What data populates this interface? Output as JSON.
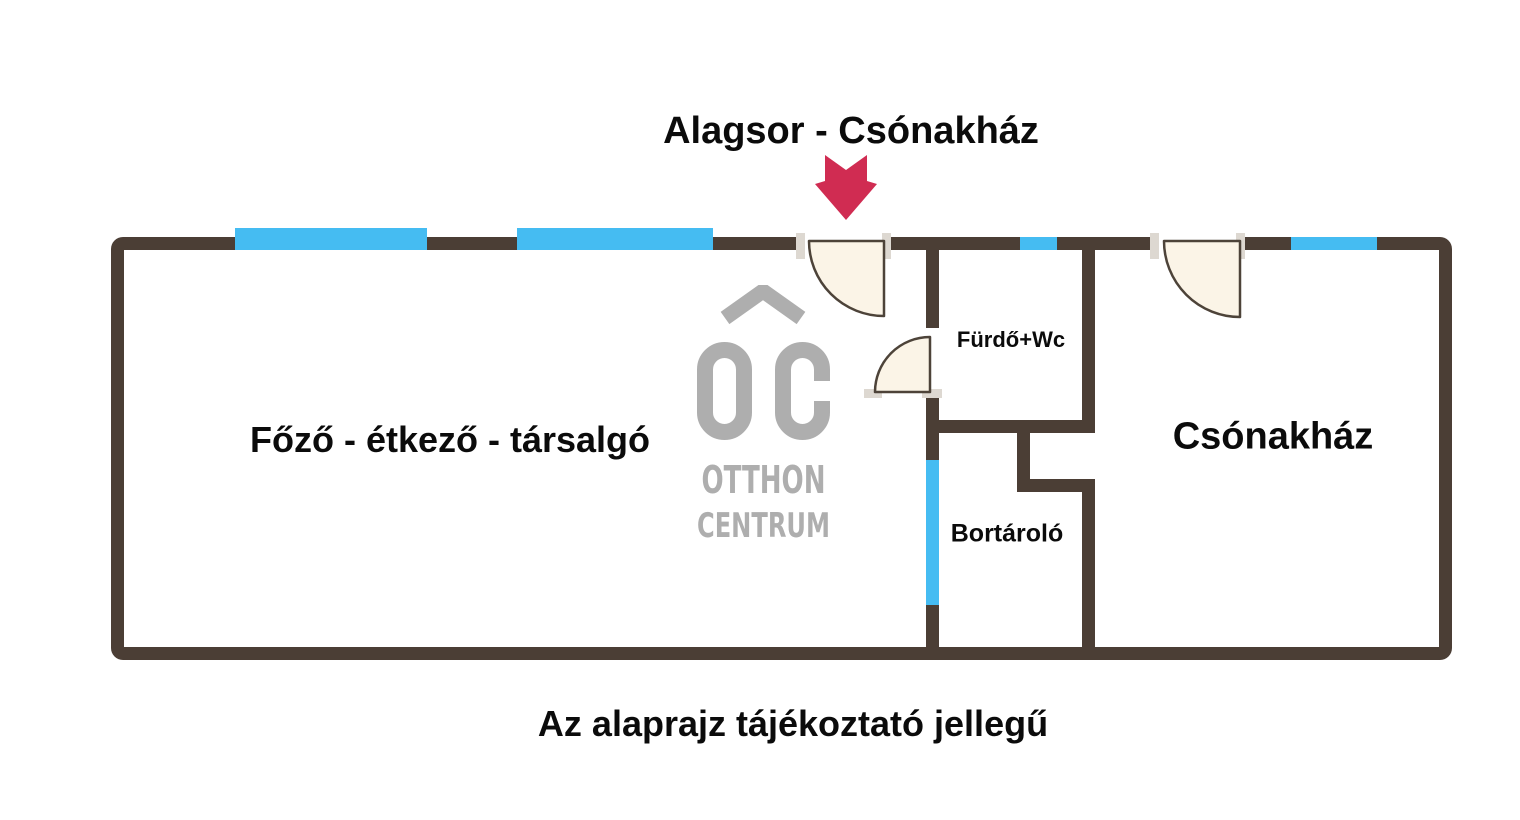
{
  "title": "Alagsor - Csónakház",
  "caption": "Az alaprajz tájékoztató jellegű",
  "logo": {
    "line1": "OTTHON",
    "line2": "CENTRUM"
  },
  "colors": {
    "wall": "#4B3E35",
    "window": "#45BCF2",
    "door_fill": "#FBF4E7",
    "door_stroke": "#4D4339",
    "hinge": "#DDD8D1",
    "arrow": "#D02C52",
    "logo": "#AEAEAE",
    "text": "#0B0B0B"
  },
  "rooms": [
    {
      "id": "fozo-etkezo-tarsalgo",
      "label": "Főző - étkező - társalgó",
      "cx": 450,
      "cy": 440,
      "font_size": 36
    },
    {
      "id": "furdo-wc",
      "label": "Fürdő+Wc",
      "cx": 1011,
      "cy": 340,
      "font_size": 22
    },
    {
      "id": "bortarolo",
      "label": "Bortároló",
      "cx": 1007,
      "cy": 534,
      "font_size": 25
    },
    {
      "id": "csonakhaz",
      "label": "Csónakház",
      "cx": 1273,
      "cy": 437,
      "font_size": 38
    }
  ],
  "floorplan": {
    "outer": {
      "x": 111,
      "y": 237,
      "w": 1341,
      "h": 423,
      "thickness": 13
    },
    "walls": [
      {
        "x": 926,
        "y": 249,
        "w": 13,
        "h": 79
      },
      {
        "x": 926,
        "y": 395,
        "w": 13,
        "h": 65
      },
      {
        "x": 926,
        "y": 605,
        "w": 13,
        "h": 43
      },
      {
        "x": 1082,
        "y": 249,
        "w": 13,
        "h": 183
      },
      {
        "x": 1082,
        "y": 482,
        "w": 13,
        "h": 166
      },
      {
        "x": 926,
        "y": 420,
        "w": 169,
        "h": 13
      },
      {
        "x": 1017,
        "y": 432,
        "w": 13,
        "h": 60
      },
      {
        "x": 1017,
        "y": 479,
        "w": 78,
        "h": 13,
        "radius": "0 0 0 6px"
      }
    ],
    "door_gaps": [
      {
        "x": 803,
        "y": 236,
        "w": 84,
        "h": 15
      },
      {
        "x": 1157,
        "y": 236,
        "w": 86,
        "h": 15
      }
    ],
    "windows": [
      {
        "x": 235,
        "y": 228,
        "w": 192,
        "h": 22
      },
      {
        "x": 517,
        "y": 228,
        "w": 196,
        "h": 22
      },
      {
        "x": 1020,
        "y": 237,
        "w": 37,
        "h": 13
      },
      {
        "x": 1291,
        "y": 237,
        "w": 86,
        "h": 13
      },
      {
        "x": 926,
        "y": 460,
        "w": 13,
        "h": 145
      }
    ],
    "hinges": [
      {
        "x": 796,
        "y": 233,
        "w": 9,
        "h": 26
      },
      {
        "x": 882,
        "y": 233,
        "w": 9,
        "h": 26
      },
      {
        "x": 1150,
        "y": 233,
        "w": 9,
        "h": 26
      },
      {
        "x": 1236,
        "y": 233,
        "w": 9,
        "h": 26
      },
      {
        "x": 864,
        "y": 389,
        "w": 18,
        "h": 9
      },
      {
        "x": 922,
        "y": 389,
        "w": 20,
        "h": 9
      }
    ],
    "doors": [
      {
        "cx": 884,
        "cy": 241,
        "r": 75,
        "p1": [
          809,
          241
        ],
        "p2": [
          884,
          316
        ]
      },
      {
        "cx": 930,
        "cy": 392,
        "r": 55,
        "p1": [
          930,
          337
        ],
        "p2": [
          875,
          392
        ]
      },
      {
        "cx": 1240,
        "cy": 241,
        "r": 76,
        "p1": [
          1164,
          241
        ],
        "p2": [
          1240,
          317
        ]
      }
    ]
  }
}
